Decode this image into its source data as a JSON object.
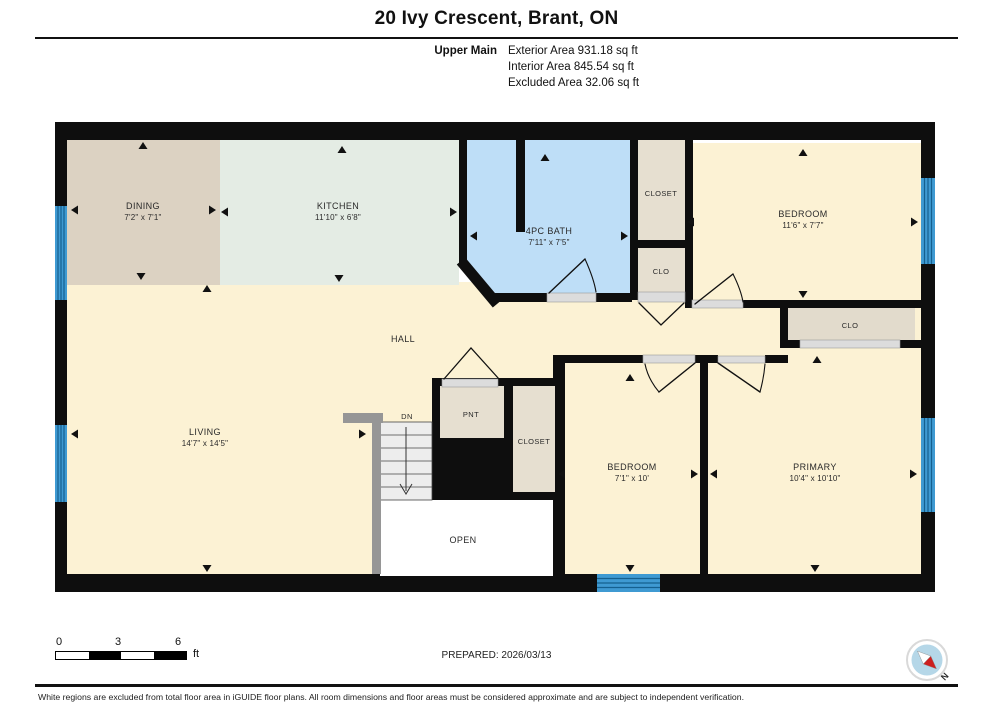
{
  "header": {
    "title": "20 Ivy Crescent, Brant, ON",
    "floor_label": "Upper Main",
    "exterior_area": "Exterior Area 931.18 sq ft",
    "interior_area": "Interior Area 845.54 sq ft",
    "excluded_area": "Excluded Area 32.06 sq ft"
  },
  "rooms": {
    "dining": {
      "name": "DINING",
      "dims": "7'2\" x 7'1\""
    },
    "kitchen": {
      "name": "KITCHEN",
      "dims": "11'10\" x 6'8\""
    },
    "bath": {
      "name": "4PC BATH",
      "dims": "7'11\" x 7'5\""
    },
    "closet_top": {
      "name": "CLOSET"
    },
    "bedroom_tr": {
      "name": "BEDROOM",
      "dims": "11'6\" x 7'7\""
    },
    "clo_hall": {
      "name": "CLO"
    },
    "clo_primary": {
      "name": "CLO"
    },
    "hall": {
      "name": "HALL"
    },
    "living": {
      "name": "LIVING",
      "dims": "14'7\" x 14'5\""
    },
    "pantry": {
      "name": "PNT"
    },
    "closet_mid": {
      "name": "CLOSET"
    },
    "bedroom_mid": {
      "name": "BEDROOM",
      "dims": "7'1\" x 10'"
    },
    "primary": {
      "name": "PRIMARY",
      "dims": "10'4\" x 10'10\""
    },
    "open": {
      "name": "OPEN"
    },
    "stairs": {
      "label": "DN"
    }
  },
  "scale_bar": {
    "tick_0": "0",
    "tick_3": "3",
    "tick_6": "6",
    "unit": "ft"
  },
  "prepared_label": "PREPARED: 2026/03/13",
  "compass": {
    "north_label": "N"
  },
  "footer": {
    "disclaimer": "White regions are excluded from total floor area in iGUIDE floor plans. All room dimensions and floor areas must be considered approximate and are subject to independent verification."
  },
  "colors": {
    "wall": "#0e0e0e",
    "room_yellow": "#fcf2d4",
    "dining_tan": "#dcd2c2",
    "kitchen_mint": "#e4ece4",
    "bath_blue": "#bedef7",
    "closet_beige": "#e6dfd0",
    "window_blue": "#3f9ad2",
    "window_stripe": "#15608f",
    "compass_red": "#cc1f1f",
    "compass_blue": "#b5d7e8"
  }
}
